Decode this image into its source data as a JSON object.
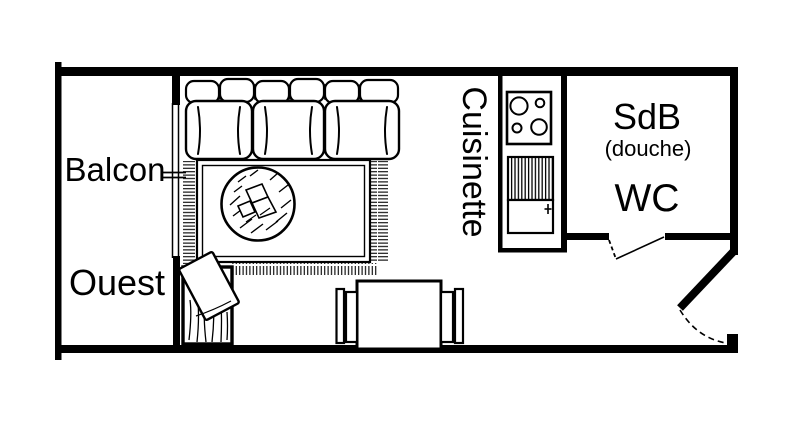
{
  "floorplan": {
    "colors": {
      "ink": "#000000",
      "background": "#ffffff"
    },
    "rooms": {
      "balcony": {
        "label": "Balcon",
        "orientation": "Ouest"
      },
      "kitchenette": {
        "label": "Cuisinette"
      },
      "bathroom": {
        "label": "SdB",
        "note": "(douche)",
        "wc": "WC"
      }
    }
  }
}
